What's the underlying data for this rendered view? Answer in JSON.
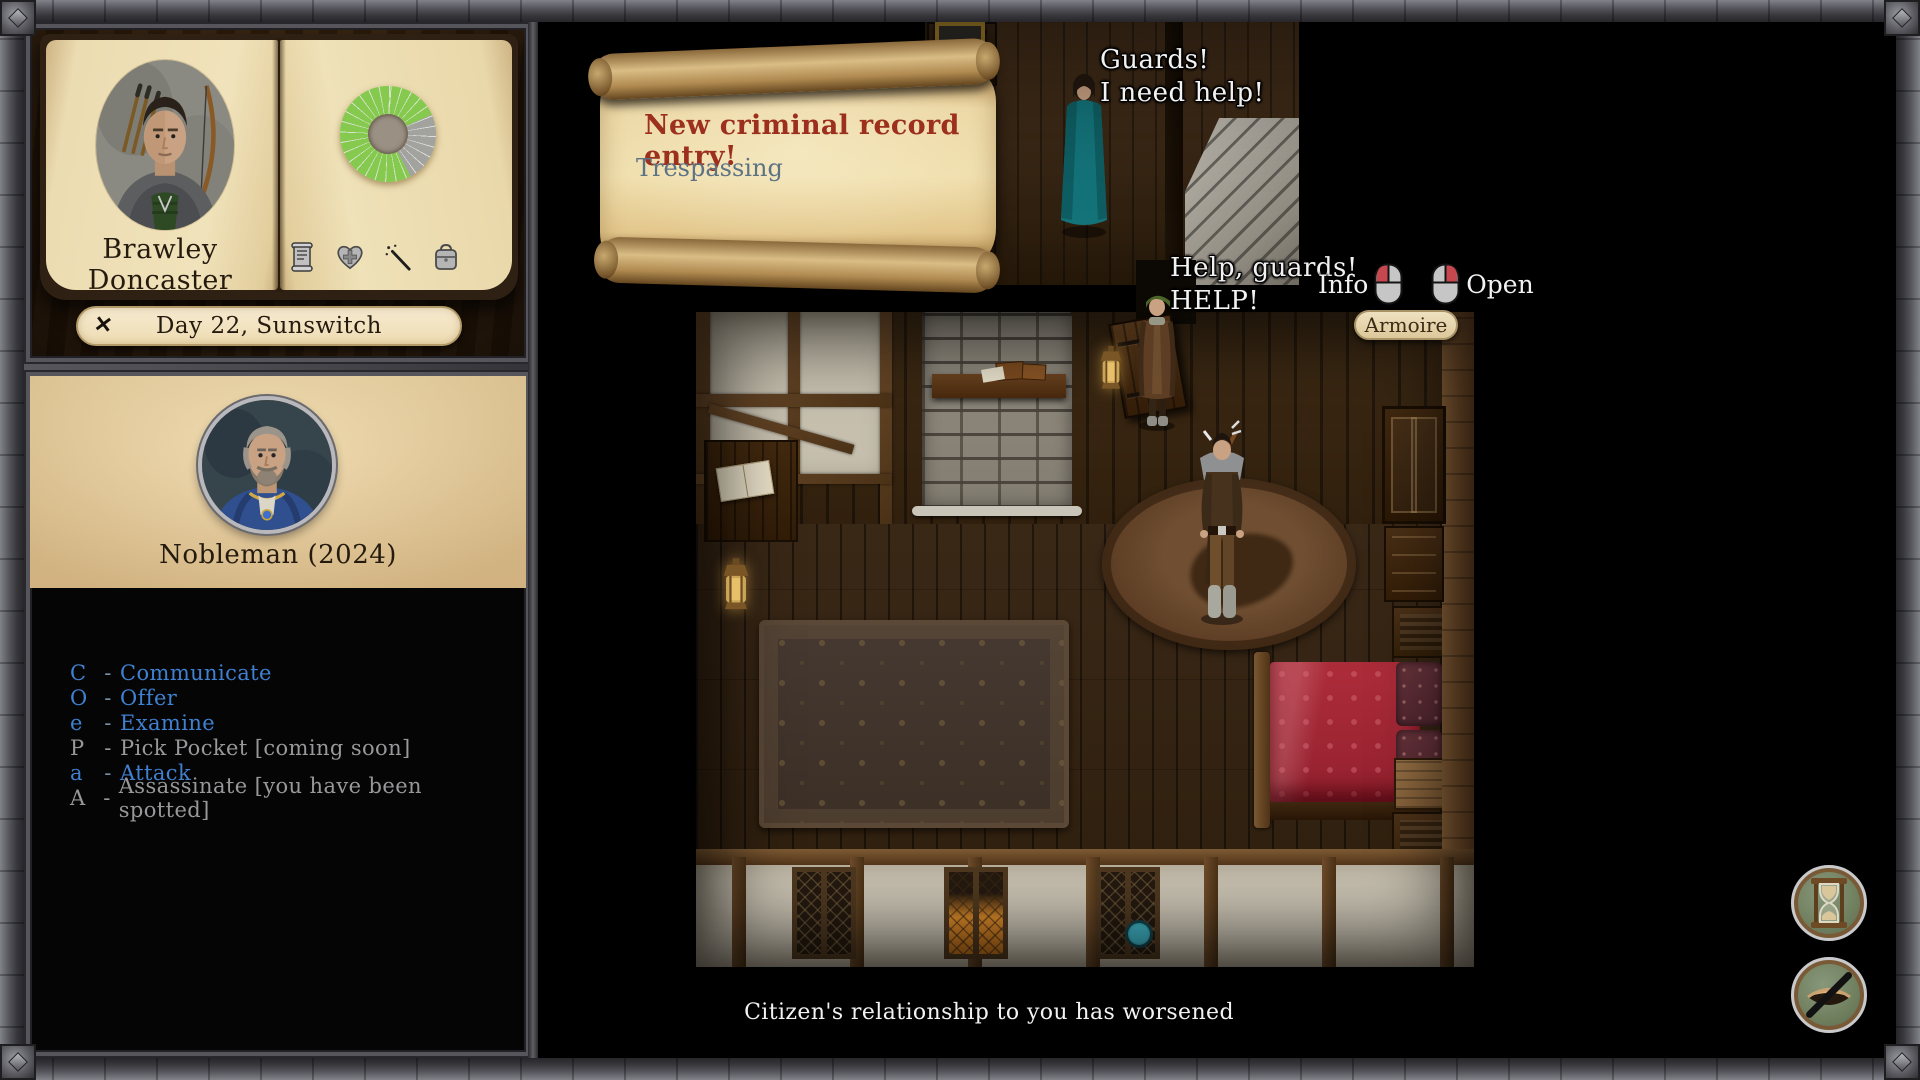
{
  "sidebar": {
    "character": {
      "name": "Brawley Doncaster",
      "page_icons": [
        "records-scroll-icon",
        "health-heart-icon",
        "magic-wand-icon",
        "inventory-bag-icon"
      ],
      "stat_wheel": {
        "green": "#85c94f",
        "gray": "#a2a29e",
        "center": "#8d8377"
      }
    },
    "day_banner": {
      "text": "Day 22, Sunswitch",
      "close_glyph": "✕"
    },
    "target": {
      "title": "Nobleman (2024)"
    },
    "actions": {
      "separator": "-",
      "items": [
        {
          "key": "C",
          "label": "Communicate",
          "enabled": true
        },
        {
          "key": "O",
          "label": "Offer",
          "enabled": true
        },
        {
          "key": "e",
          "label": "Examine",
          "enabled": true
        },
        {
          "key": "P",
          "label": "Pick Pocket [coming soon]",
          "enabled": false
        },
        {
          "key": "a",
          "label": "Attack",
          "enabled": true
        },
        {
          "key": "A",
          "label": "Assassinate [you have been spotted]",
          "enabled": false
        }
      ]
    }
  },
  "viewport": {
    "notification_scroll": {
      "title": "New criminal record entry!",
      "body": "Trespassing"
    },
    "speech_guard_call": {
      "line1": "Guards!",
      "line2": "I need help!"
    },
    "speech_noble_call": {
      "line1": "Help, guards!",
      "line2": "HELP!"
    },
    "hover_legend": {
      "info_label": "Info",
      "info_button": "mouse-left-icon",
      "open_label": "Open",
      "open_button": "mouse-right-icon"
    },
    "tooltip": {
      "text": "Armoire"
    },
    "status_message": "Citizen's relationship to you has worsened",
    "hud": {
      "wait_button_icon": "hourglass-icon",
      "stealth_button_icon": "eye-slash-icon"
    }
  },
  "colors": {
    "action_enabled": "#4080d0",
    "action_disabled": "#98989a",
    "scroll_title_red": "#9c2f1d",
    "scroll_body_blue": "#5d7385",
    "parchment": "#ecd8a6",
    "page_cream": "#efe1b8",
    "banner_cream": "#f6ead0",
    "target_panel_tan": "#eed7a6",
    "mouse_highlight_red": "#c7474e",
    "bed_red": "#a62836",
    "dress_teal": "#137379"
  }
}
